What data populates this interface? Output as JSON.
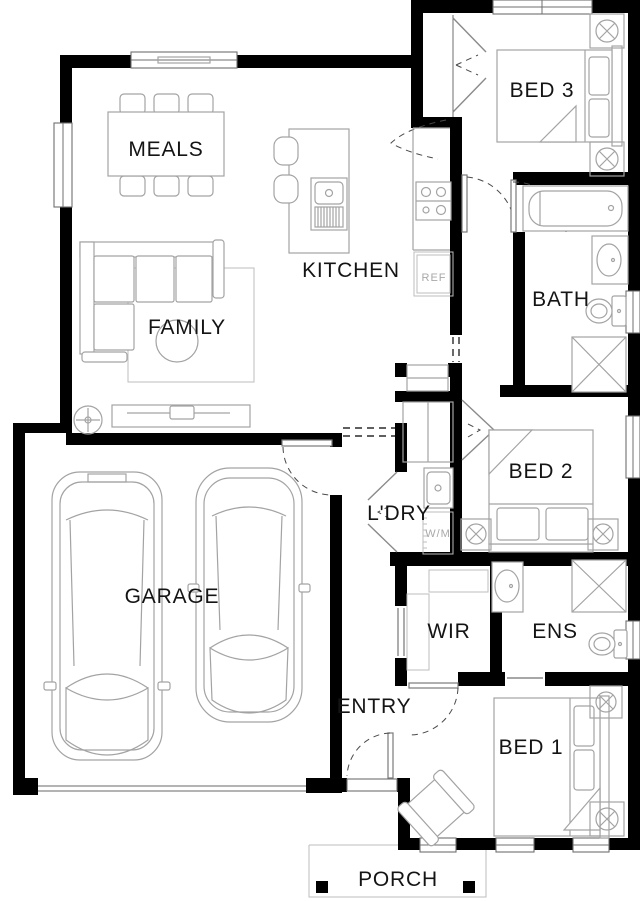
{
  "plan": {
    "title": "Single storey house floor plan",
    "rooms": {
      "meals": "MEALS",
      "kitchen": "KITCHEN",
      "family": "FAMILY",
      "garage": "GARAGE",
      "entry": "ENTRY",
      "porch": "PORCH",
      "bed1": "BED 1",
      "bed2": "BED 2",
      "bed3": "BED 3",
      "bath": "BATH",
      "ens": "ENS",
      "wir": "WIR",
      "laundry": "L'DRY"
    },
    "appliances": {
      "fridge": "REF",
      "washer": "W/M"
    },
    "icons": [
      "bathtub-icon",
      "shower-icon",
      "toilet-icon",
      "vanity-basin-icon",
      "sink-icon",
      "cooktop-icon",
      "ceiling-fan-icon",
      "ceiling-light-icon",
      "car-icon",
      "bed-icon",
      "sofa-icon",
      "dining-table-icon",
      "washing-machine-icon",
      "laundry-tub-icon"
    ],
    "colors": {
      "wall": "#000000",
      "background": "#ffffff",
      "furniture_line": "#a3a3a3",
      "label": "#141414",
      "muted_label": "#a8a8a8"
    }
  }
}
